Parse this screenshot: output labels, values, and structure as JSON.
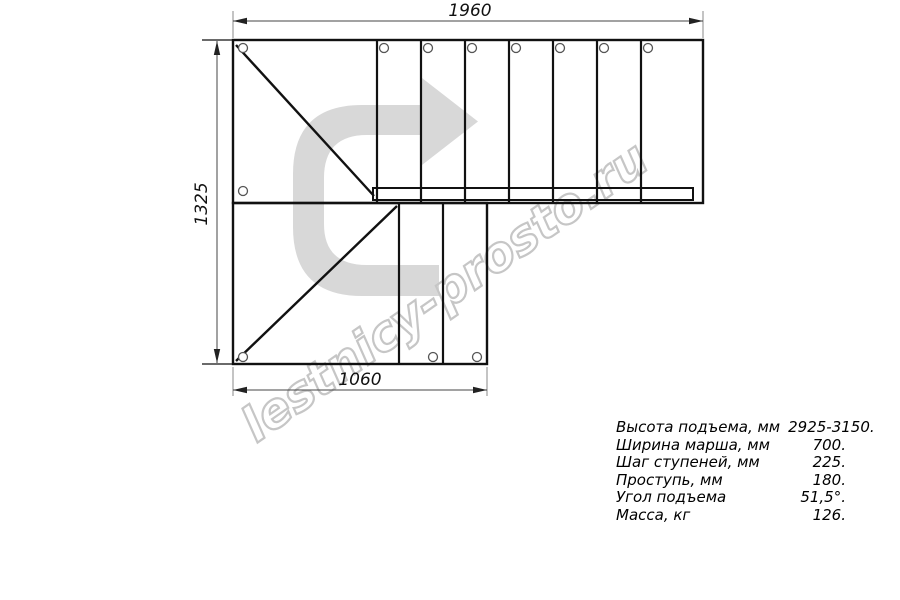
{
  "drawing": {
    "dim_top": "1960",
    "dim_left": "1325",
    "dim_bottom": "1060",
    "watermark": "lestnicy-prosto.ru"
  },
  "specs": [
    {
      "label": "Высота подъема, мм",
      "value": "2925-3150."
    },
    {
      "label": "Ширина марша, мм",
      "value": "700."
    },
    {
      "label": "Шаг ступеней, мм",
      "value": "225."
    },
    {
      "label": "Проступь, мм",
      "value": "180."
    },
    {
      "label": "Угол подъема",
      "value": "51,5°."
    },
    {
      "label": "Масса, кг",
      "value": "126."
    }
  ],
  "colors": {
    "line": "#111111",
    "dim_line": "#666666",
    "arrow_fill": "#d8d8d8",
    "watermark_stroke": "#c6c6c6",
    "background": "#ffffff"
  }
}
